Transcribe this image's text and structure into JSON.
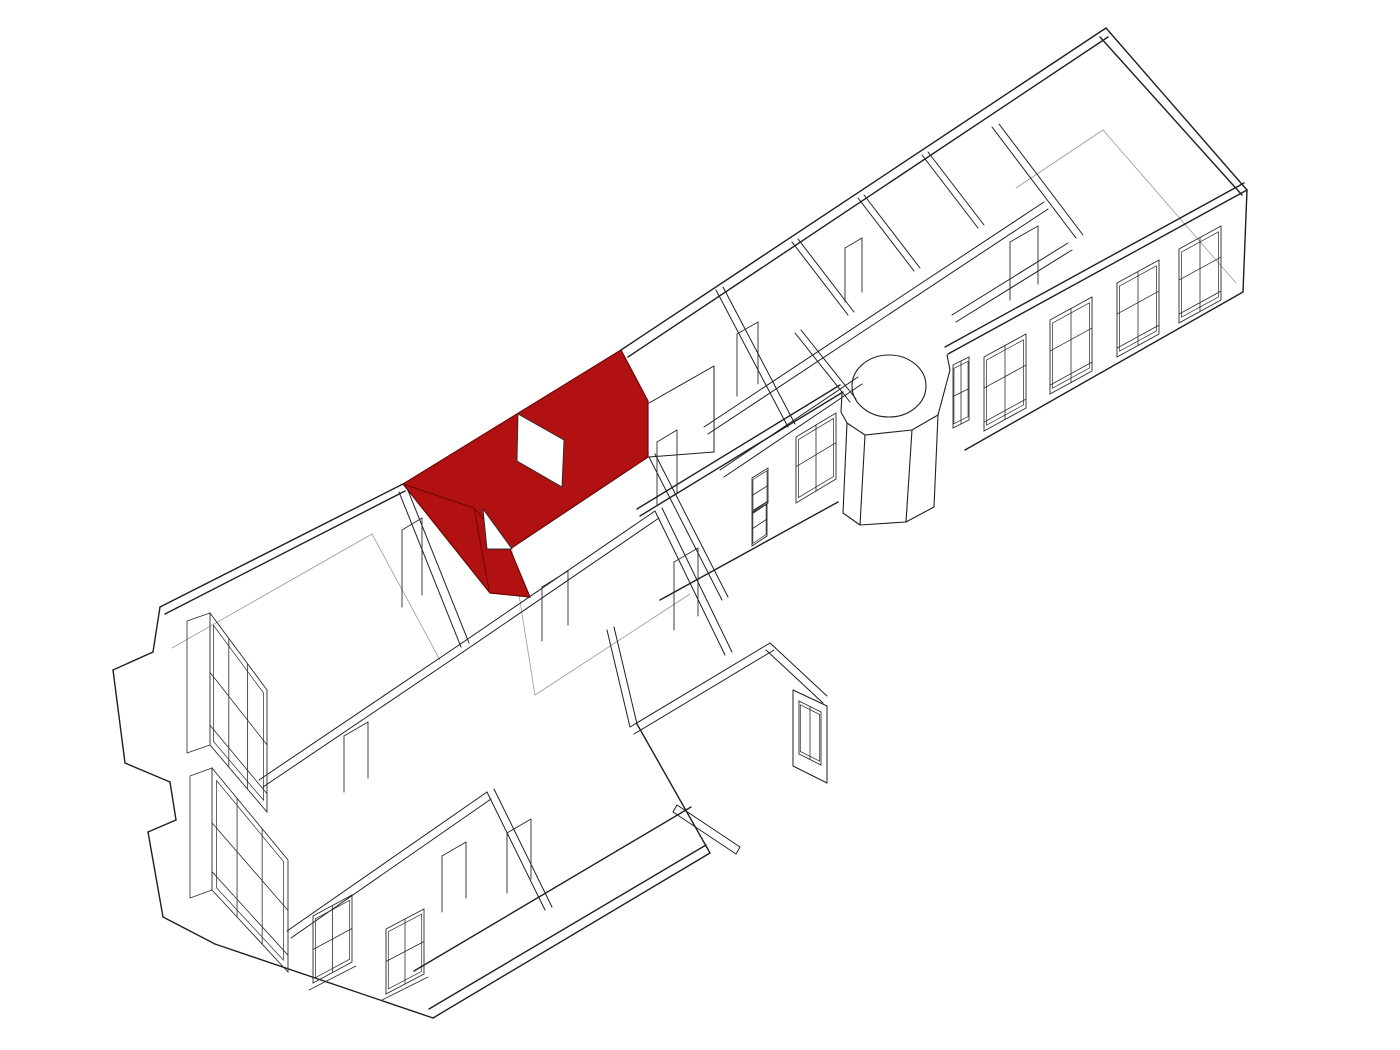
{
  "meta": {
    "kind": "architectural-axonometric-cutaway",
    "description_name": "floor-plan-with-highlighted-room",
    "background": "#ffffff"
  },
  "palette": {
    "line_main": "#1f1f1f",
    "line_detail": "#2a2a2a",
    "line_faint": "#9a9a9a",
    "red_fill": "#b11111",
    "red_line": "#6d0707",
    "white": "#ffffff"
  },
  "canvas": {
    "w": 1400,
    "h": 1050
  },
  "highlight_room": {
    "name": "selected-room",
    "fill": "#b11111",
    "outline": [
      621,
      350,
      648,
      401,
      648,
      457,
      510,
      549,
      530,
      597,
      490,
      593,
      403,
      484
    ],
    "window_hole": [
      518,
      414,
      564,
      440,
      562,
      487,
      517,
      461
    ],
    "door_notch": [
      483,
      509,
      512,
      549,
      487,
      549
    ],
    "fold_lines": [
      [
        403,
        484,
        474,
        508
      ],
      [
        474,
        508,
        510,
        549
      ],
      [
        474,
        508,
        489,
        590
      ]
    ]
  },
  "silhouette": {
    "w": 1.4,
    "lines": [
      [
        1106,
        28,
        621,
        350
      ],
      [
        403,
        484,
        160,
        607
      ],
      [
        1106,
        28,
        1247,
        190
      ],
      [
        1247,
        190,
        1243,
        292
      ],
      [
        1243,
        292,
        965,
        450
      ],
      [
        1247,
        190,
        948,
        354
      ],
      [
        1244,
        183,
        945,
        347
      ],
      [
        628,
        357,
        1108,
        37
      ],
      [
        1100,
        37,
        1242,
        195
      ],
      [
        843,
        392,
        640,
        516
      ],
      [
        840,
        385,
        637,
        509
      ],
      [
        838,
        502,
        660,
        600
      ],
      [
        165,
        614,
        405,
        491
      ],
      [
        160,
        607,
        153,
        652
      ],
      [
        153,
        652,
        113,
        670
      ],
      [
        113,
        670,
        125,
        763
      ],
      [
        125,
        763,
        170,
        782
      ],
      [
        170,
        782,
        176,
        820
      ],
      [
        176,
        820,
        148,
        832
      ],
      [
        148,
        832,
        163,
        917
      ],
      [
        163,
        917,
        215,
        944
      ],
      [
        215,
        944,
        433,
        1018
      ],
      [
        433,
        1018,
        710,
        853
      ],
      [
        429,
        1009,
        706,
        845
      ],
      [
        414,
        971,
        691,
        807
      ],
      [
        710,
        853,
        637,
        724
      ]
    ]
  },
  "rotunda": {
    "w": 1.1,
    "ellipse": {
      "cx": 889,
      "cy": 386,
      "rx": 37,
      "ry": 31
    },
    "outline": [
      950,
      370,
      938,
      415,
      912,
      430,
      865,
      435,
      847,
      423,
      841,
      412
    ],
    "lines": [
      [
        938,
        415,
        934,
        507
      ],
      [
        912,
        430,
        906,
        522
      ],
      [
        865,
        435,
        860,
        525
      ],
      [
        847,
        423,
        843,
        513
      ],
      [
        934,
        507,
        906,
        522
      ],
      [
        906,
        522,
        860,
        525
      ],
      [
        860,
        525,
        843,
        513
      ],
      [
        950,
        370,
        947,
        355
      ],
      [
        841,
        412,
        842,
        394
      ]
    ]
  },
  "upper_interior": {
    "w": 1.0,
    "lines": [
      [
        704,
        427,
        1044,
        202
      ],
      [
        708,
        434,
        1048,
        209
      ],
      [
        720,
        470,
        858,
        377
      ],
      [
        724,
        477,
        862,
        384
      ],
      [
        952,
        315,
        1068,
        243
      ],
      [
        956,
        322,
        1072,
        250
      ],
      [
        992,
        127,
        1076,
        238
      ],
      [
        999,
        124,
        1083,
        235
      ],
      [
        792,
        242,
        848,
        315
      ],
      [
        798,
        239,
        854,
        312
      ],
      [
        858,
        198,
        914,
        271
      ],
      [
        864,
        195,
        920,
        268
      ],
      [
        922,
        155,
        978,
        228
      ],
      [
        928,
        152,
        984,
        225
      ],
      [
        716,
        290,
        788,
        427
      ],
      [
        723,
        287,
        795,
        424
      ],
      [
        795,
        333,
        850,
        402
      ],
      [
        801,
        330,
        856,
        399
      ],
      [
        649,
        403,
        714,
        366
      ],
      [
        714,
        366,
        714,
        452
      ],
      [
        714,
        452,
        649,
        457
      ]
    ]
  },
  "lower_interior": {
    "w": 1.0,
    "lines": [
      [
        259,
        780,
        459,
        645
      ],
      [
        263,
        787,
        463,
        652
      ],
      [
        287,
        931,
        487,
        792
      ],
      [
        291,
        938,
        491,
        799
      ],
      [
        399,
        492,
        461,
        647
      ],
      [
        407,
        488,
        469,
        643
      ],
      [
        459,
        645,
        655,
        511
      ],
      [
        463,
        652,
        659,
        518
      ],
      [
        487,
        792,
        545,
        910
      ],
      [
        494,
        789,
        552,
        907
      ],
      [
        655,
        511,
        725,
        655
      ],
      [
        662,
        508,
        732,
        652
      ],
      [
        607,
        630,
        630,
        727
      ],
      [
        614,
        627,
        637,
        724
      ],
      [
        630,
        727,
        770,
        643
      ],
      [
        634,
        734,
        774,
        650
      ],
      [
        770,
        643,
        827,
        696
      ],
      [
        766,
        650,
        823,
        703
      ],
      [
        793,
        690,
        827,
        706
      ],
      [
        827,
        706,
        827,
        783
      ],
      [
        793,
        690,
        793,
        766
      ],
      [
        793,
        766,
        827,
        783
      ],
      [
        677,
        805,
        740,
        847
      ],
      [
        673,
        812,
        736,
        854
      ],
      [
        677,
        805,
        673,
        812
      ],
      [
        740,
        847,
        736,
        854
      ],
      [
        649,
        457,
        722,
        600
      ],
      [
        655,
        454,
        728,
        597
      ]
    ]
  },
  "windows": {
    "w": 0.9,
    "items": [
      {
        "name": "facade-window-1",
        "q": [
          [
            1179,
            249
          ],
          [
            1221,
            226
          ],
          [
            1221,
            300
          ],
          [
            1179,
            323
          ]
        ],
        "vm": [
          0.5
        ],
        "hm": [
          0.42,
          0.88
        ]
      },
      {
        "name": "facade-window-2",
        "q": [
          [
            1117,
            283
          ],
          [
            1159,
            260
          ],
          [
            1159,
            334
          ],
          [
            1117,
            357
          ]
        ],
        "vm": [
          0.5
        ],
        "hm": [
          0.42,
          0.88
        ]
      },
      {
        "name": "facade-window-3",
        "q": [
          [
            1050,
            320
          ],
          [
            1092,
            297
          ],
          [
            1092,
            371
          ],
          [
            1050,
            394
          ]
        ],
        "vm": [
          0.5
        ],
        "hm": [
          0.42,
          0.88
        ]
      },
      {
        "name": "facade-window-4",
        "q": [
          [
            984,
            357
          ],
          [
            1026,
            334
          ],
          [
            1026,
            408
          ],
          [
            984,
            431
          ]
        ],
        "vm": [
          0.5
        ],
        "hm": [
          0.42,
          0.88
        ]
      },
      {
        "name": "facade-window-small",
        "q": [
          [
            953,
            365
          ],
          [
            969,
            357
          ],
          [
            969,
            420
          ],
          [
            953,
            428
          ]
        ],
        "vm": [
          0.5
        ],
        "hm": [
          0.5
        ]
      },
      {
        "name": "court-window-medium",
        "q": [
          [
            796,
            437
          ],
          [
            836,
            413
          ],
          [
            836,
            479
          ],
          [
            796,
            503
          ]
        ],
        "vm": [
          0.5
        ],
        "hm": [
          0.45
        ]
      },
      {
        "name": "court-window-small-1",
        "q": [
          [
            752,
            478
          ],
          [
            768,
            468
          ],
          [
            768,
            503
          ],
          [
            752,
            513
          ]
        ],
        "vm": [],
        "hm": [
          0.5
        ]
      },
      {
        "name": "court-window-small-2",
        "q": [
          [
            752,
            512
          ],
          [
            767,
            502
          ],
          [
            767,
            536
          ],
          [
            752,
            546
          ]
        ],
        "vm": [],
        "hm": [
          0.5
        ]
      },
      {
        "name": "french-window-1",
        "q": [
          [
            210,
            613
          ],
          [
            267,
            690
          ],
          [
            267,
            812
          ],
          [
            210,
            745
          ]
        ],
        "vm": [
          0.33,
          0.66
        ],
        "hm": [
          0.45,
          0.85
        ]
      },
      {
        "name": "french-window-2",
        "q": [
          [
            212,
            768
          ],
          [
            288,
            860
          ],
          [
            288,
            972
          ],
          [
            212,
            890
          ]
        ],
        "vm": [
          0.33,
          0.66
        ],
        "hm": [
          0.45,
          0.85
        ]
      },
      {
        "name": "south-window-1",
        "q": [
          [
            313,
            916
          ],
          [
            352,
            895
          ],
          [
            352,
            962
          ],
          [
            313,
            983
          ]
        ],
        "vm": [
          0.5
        ],
        "hm": [
          0.5
        ]
      },
      {
        "name": "south-window-2",
        "q": [
          [
            386,
            929
          ],
          [
            424,
            909
          ],
          [
            424,
            974
          ],
          [
            386,
            994
          ]
        ],
        "vm": [
          0.5
        ],
        "hm": [
          0.5
        ]
      },
      {
        "name": "spur-window",
        "q": [
          [
            799,
            701
          ],
          [
            821,
            712
          ],
          [
            821,
            765
          ],
          [
            799,
            754
          ]
        ],
        "vm": [
          0.5
        ],
        "hm": []
      }
    ],
    "extra_lines": [
      [
        210,
        613,
        187,
        621
      ],
      [
        187,
        621,
        187,
        753
      ],
      [
        187,
        753,
        210,
        745
      ],
      [
        212,
        768,
        190,
        776
      ],
      [
        190,
        776,
        190,
        898
      ],
      [
        190,
        898,
        212,
        890
      ],
      [
        309,
        990,
        356,
        966
      ],
      [
        382,
        1000,
        428,
        977
      ]
    ]
  },
  "doors": {
    "w": 0.9,
    "items": [
      {
        "name": "door-1",
        "lines": [
          [
            344,
            736,
            344,
            792
          ],
          [
            368,
            722,
            368,
            778
          ],
          [
            344,
            736,
            368,
            722
          ]
        ]
      },
      {
        "name": "door-2",
        "lines": [
          [
            442,
            856,
            442,
            912
          ],
          [
            466,
            842,
            466,
            898
          ],
          [
            442,
            856,
            466,
            842
          ]
        ]
      },
      {
        "name": "door-3",
        "lines": [
          [
            402,
            530,
            402,
            607
          ],
          [
            422,
            518,
            422,
            595
          ],
          [
            402,
            530,
            422,
            518
          ]
        ]
      },
      {
        "name": "door-4",
        "lines": [
          [
            674,
            562,
            674,
            630
          ],
          [
            698,
            548,
            698,
            616
          ],
          [
            674,
            562,
            698,
            548
          ]
        ]
      },
      {
        "name": "door-5",
        "lines": [
          [
            507,
            833,
            507,
            893
          ],
          [
            531,
            819,
            531,
            879
          ],
          [
            507,
            833,
            531,
            819
          ]
        ]
      },
      {
        "name": "door-6",
        "lines": [
          [
            657,
            442,
            657,
            505
          ],
          [
            677,
            430,
            677,
            493
          ],
          [
            657,
            442,
            677,
            430
          ]
        ]
      },
      {
        "name": "door-7",
        "lines": [
          [
            1010,
            242,
            1010,
            300
          ],
          [
            1038,
            226,
            1038,
            284
          ],
          [
            1010,
            242,
            1038,
            226
          ]
        ]
      },
      {
        "name": "door-8",
        "lines": [
          [
            845,
            248,
            845,
            302
          ],
          [
            862,
            238,
            862,
            292
          ],
          [
            845,
            248,
            862,
            238
          ]
        ]
      },
      {
        "name": "door-9",
        "lines": [
          [
            737,
            334,
            737,
            396
          ],
          [
            758,
            322,
            758,
            384
          ],
          [
            737,
            334,
            758,
            322
          ]
        ]
      },
      {
        "name": "door-10",
        "lines": [
          [
            542,
            587,
            542,
            641
          ],
          [
            568,
            571,
            568,
            625
          ],
          [
            542,
            587,
            568,
            571
          ]
        ]
      }
    ]
  },
  "floor_lines": {
    "w": 0.8,
    "lines": [
      [
        1103,
        130,
        1236,
        283
      ],
      [
        1103,
        130,
        1016,
        188
      ],
      [
        172,
        648,
        372,
        534
      ],
      [
        372,
        534,
        440,
        660
      ],
      [
        512,
        551,
        535,
        695
      ],
      [
        535,
        695,
        690,
        594
      ]
    ]
  }
}
